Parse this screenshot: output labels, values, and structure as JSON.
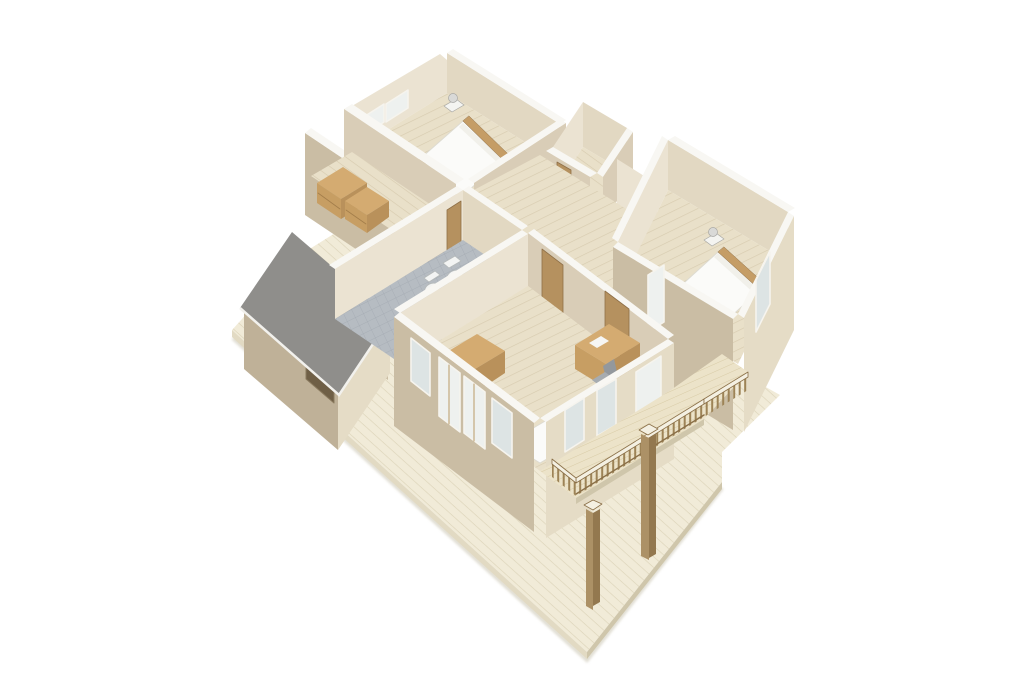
{
  "meta": {
    "kind": "3d-isometric-floor-plan-render",
    "description": "Cutaway axonometric rendering of a house upper storey on a wooden deck"
  },
  "palette": {
    "background": "#ffffff",
    "deckTop": "#f1ebd8",
    "deckStripe": "#dcd3b8",
    "deckEdge": "#e2dac3",
    "deckEdgeDark": "#cfc6ab",
    "groundShadow": "#d9d5c7",
    "floorWood": "#e9e0c9",
    "floorStripe": "#d7cbaf",
    "balconyTop": "#ece3c9",
    "balconyStripe": "#d8cba6",
    "tile": "#b6bcc2",
    "tileLine": "#a2a9b1",
    "wallTop": "#f8f7f3",
    "wallLight": "#ebe3d2",
    "wallMid": "#d9cdb7",
    "wallMid2": "#e2d8c2",
    "wallShade": "#cabda4",
    "wallDark": "#bfb198",
    "wallExtLight": "#e5dcc6",
    "roofGray": "#8f8e8b",
    "roofFascia": "#f2f1ed",
    "glass": "#eef1ef",
    "glassBlue": "#dde4e4",
    "windowFrame": "#f6f4ee",
    "windowWood": "#bfa274",
    "doorBrown": "#b5915f",
    "doorDark": "#8f7048",
    "dresserTop": "#d4ab71",
    "dresserFront": "#c79e63",
    "dresserSide": "#b9915b",
    "drawerLine": "#a37e4b",
    "bedWhite": "#fbfbf9",
    "bedOutline": "#dddbd2",
    "pillow": "#f1f0ea",
    "bedFrame": "#b28a52",
    "headboard": "#c59d66",
    "nightstand": "#f4f4f1",
    "lampGray": "#d9d9d7",
    "lampEdge": "#a8a8a5",
    "stairWhite": "#efeeec",
    "stairLine": "#cbcac6",
    "stairShade": "#e2e1dd",
    "railTop": "#f4f0e2",
    "baluster": "#9d8356",
    "balusterDark": "#8a6f47",
    "postWood": "#ac9166",
    "postDark": "#93784f",
    "porcelain": "#f3f4f3",
    "porcelainEdge": "#b5b9b9",
    "porcelainInner": "#dde1e1",
    "tubGray": "#b0b4b9",
    "tubEdge": "#90959a",
    "tubDark": "#8e9297",
    "chairGray": "#a7acb0",
    "chairDark": "#93989d",
    "paperWhite": "#f6f6f4"
  },
  "scene": {
    "ground": [
      "wood-deck"
    ],
    "structures": [
      "garage-with-gray-roof",
      "upper-storey-cutaway",
      "balcony-with-railing",
      "porch-posts"
    ],
    "rooms": [
      {
        "label": "master-bedroom",
        "furniture": [
          "double-bed",
          "nightstands",
          "table-lamps"
        ]
      },
      {
        "label": "corridor-closet",
        "furniture": [
          "dressers"
        ]
      },
      {
        "label": "walk-in-closet",
        "furniture": []
      },
      {
        "label": "staircase-well",
        "furniture": [
          "winder-stairs",
          "stair-railing"
        ]
      },
      {
        "label": "bathroom",
        "furniture": [
          "toilet",
          "bidet",
          "corner-bathtub"
        ]
      },
      {
        "label": "right-bedroom",
        "furniture": [
          "double-bed",
          "nightstands",
          "table-lamps"
        ]
      },
      {
        "label": "bottom-bedroom",
        "furniture": [
          "desk",
          "office-chair",
          "dresser",
          "single-bed"
        ]
      }
    ]
  }
}
